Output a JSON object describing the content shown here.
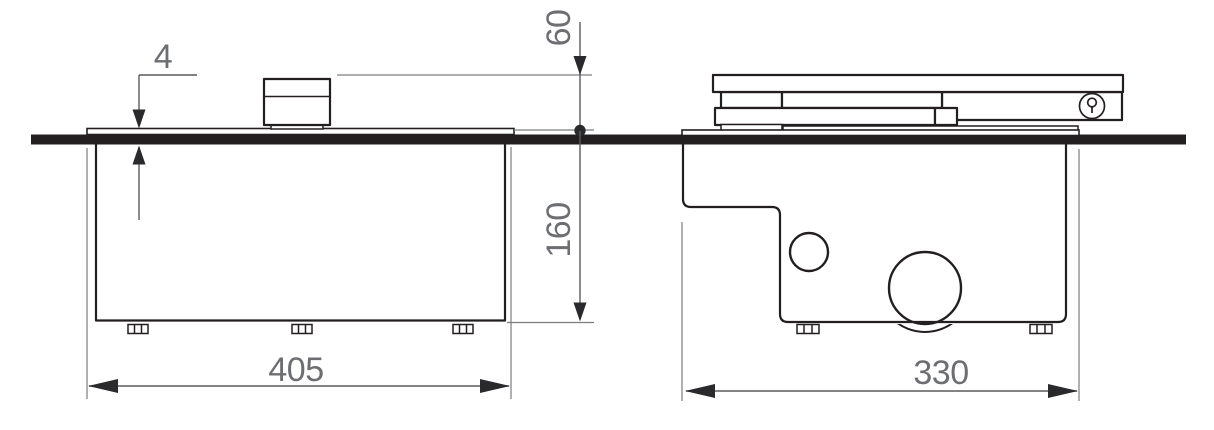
{
  "drawing": {
    "type": "technical-drawing",
    "views": {
      "front": {
        "name": "front-view"
      },
      "side": {
        "name": "side-view"
      }
    },
    "dimensions": {
      "plate_thickness": "4",
      "lid_height_above_floor": "60",
      "box_depth_below_floor": "160",
      "front_width": "405",
      "side_width": "330"
    },
    "colors": {
      "outline": "#231f20",
      "dimension_line": "#595a5c",
      "dimension_text": "#6d6e71",
      "extension_line": "#7c7d80",
      "background": "#ffffff"
    },
    "icons": {
      "lock": "key-icon"
    }
  }
}
